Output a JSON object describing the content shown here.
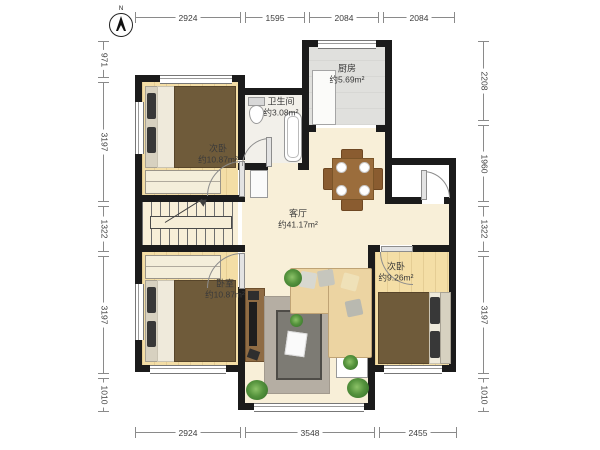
{
  "compass": {
    "label": "N"
  },
  "dimensions": {
    "top": [
      "2924",
      "1595",
      "2084",
      "2084"
    ],
    "bottom": [
      "2924",
      "3548",
      "2455"
    ],
    "left": [
      "971",
      "3197",
      "1322",
      "3197",
      "1010"
    ],
    "right": [
      "2208",
      "1960",
      "1322",
      "3197",
      "1010"
    ]
  },
  "rooms": {
    "kitchen": {
      "name": "厨房",
      "area": "约5.69m²"
    },
    "bathroom": {
      "name": "卫生间",
      "area": "约3.08m²"
    },
    "bedroom_top_left": {
      "name": "次卧",
      "area": "约10.87m²"
    },
    "living": {
      "name": "客厅",
      "area": "约41.17m²"
    },
    "bedroom_bottom_left": {
      "name": "卧室",
      "area": "约10.87m²"
    },
    "bedroom_bottom_right": {
      "name": "次卧",
      "area": "约9.26m²"
    }
  },
  "colors": {
    "wall": "#1b1b1b",
    "living_floor": "#f8efd8",
    "wood_floor": "#f4dea6",
    "kitchen_floor": "#e0e0dd",
    "bed_duvet": "#6f5b3a",
    "sofa": "#ecd4a2",
    "plant": "#4e8f3a"
  }
}
